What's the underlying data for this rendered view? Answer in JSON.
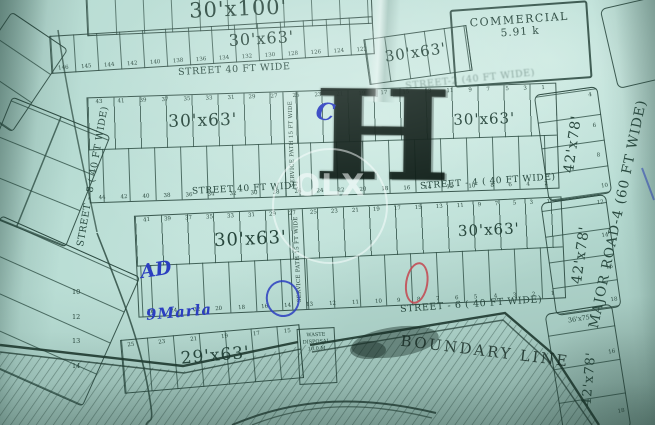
{
  "watermark": {
    "label": "OLX"
  },
  "colors": {
    "paper": "#b7dcd3",
    "ink": "#2c4c42",
    "blue_pen": "#2b3ec0",
    "red_pen": "#c4454f",
    "stamp": "#0e1c16"
  },
  "labels": {
    "plot_30x100": "30'x100'",
    "plot_30x63": "30'x63'",
    "plot_29x63": "29'x63'",
    "plot_42x78": "42'x78'",
    "plot_36x75": "36'x75'",
    "boundary": "BOUNDARY LINE",
    "service_path": "SERVICE PATH 15 FT WIDE"
  },
  "commercial": {
    "title": "COMMERCIAL",
    "area": "5.91 k"
  },
  "waste": {
    "line1": "WASTE",
    "line2": "DISPOSAL",
    "line3": "10.0 M"
  },
  "streets": {
    "top": "STREET 40 FT WIDE",
    "street2": "STREET-2 (40 FT WIDE)",
    "mid": "STREET 40 FT WIDE",
    "street4": "STREET - 4 ( 40 FT WIDE)",
    "street6": "STREET - 6 ( 40 FT WIDE)",
    "street8": "STREET - 8 ( 40 FT WIDE)",
    "major_road": "MAJOR ROAD-4 (60 FT WIDE)"
  },
  "marks": {
    "stamp_h": "H",
    "pen_c": "C",
    "pen_ad": "AD",
    "pen_note": "9Marla"
  },
  "rows": {
    "row1_numbers": [
      "146",
      "145",
      "144",
      "142",
      "140",
      "138",
      "136",
      "134",
      "132",
      "130",
      "128",
      "126",
      "124",
      "122"
    ],
    "blockA_top": [
      "43",
      "41",
      "39",
      "37",
      "35",
      "33",
      "31",
      "29",
      "27",
      "25",
      "23",
      "21",
      "19",
      "17",
      "15",
      "13",
      "11",
      "9",
      "7",
      "5",
      "3",
      "1"
    ],
    "blockA_bottom": [
      "44",
      "42",
      "40",
      "38",
      "36",
      "34",
      "32",
      "30",
      "28",
      "26",
      "24",
      "22",
      "20",
      "18",
      "16",
      "14",
      "12",
      "10",
      "8",
      "6",
      "4",
      "2"
    ],
    "blockB_top": [
      "41",
      "39",
      "37",
      "35",
      "33",
      "31",
      "29",
      "27",
      "25",
      "23",
      "21",
      "19",
      "17",
      "15",
      "13",
      "11",
      "9",
      "7",
      "5",
      "3",
      "1"
    ],
    "blockB_bottom": [
      "26",
      "24",
      "22",
      "20",
      "18",
      "16",
      "14",
      "13",
      "12",
      "11",
      "10",
      "9",
      "8",
      "7",
      "6",
      "5",
      "4",
      "3",
      "2",
      "1"
    ],
    "bottom_row_numbers": [
      "25",
      "23",
      "21",
      "19",
      "17",
      "15"
    ],
    "right_strip1_numbers": [
      "4",
      "6",
      "8",
      "10"
    ],
    "right_strip2_numbers": [
      "12",
      "14",
      "16",
      "18"
    ],
    "corner_numbers": [
      "16",
      "18"
    ],
    "left_plot_numbers": [
      "10",
      "12",
      "13",
      "14"
    ]
  }
}
